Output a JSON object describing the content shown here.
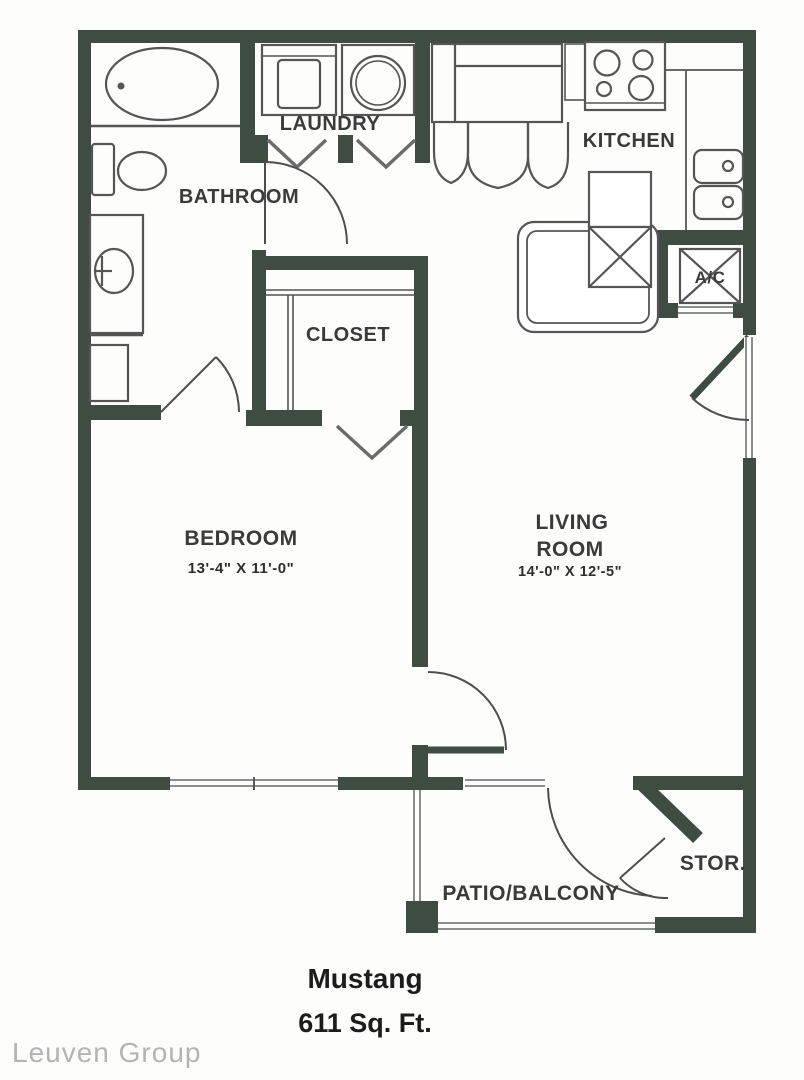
{
  "plan": {
    "title": "Mustang",
    "area": "611 Sq. Ft.",
    "watermark": "Leuven Group",
    "rooms": {
      "laundry": {
        "label": "LAUNDRY"
      },
      "bathroom": {
        "label": "BATHROOM"
      },
      "kitchen": {
        "label": "KITCHEN"
      },
      "ac_closet": {
        "label": "A/C"
      },
      "closet": {
        "label": "CLOSET"
      },
      "bedroom": {
        "label": "BEDROOM",
        "dimensions": "13'-4\" X 11'-0\""
      },
      "living_room": {
        "label_line1": "LIVING",
        "label_line2": "ROOM",
        "dimensions": "14'-0\" X 12'-5\""
      },
      "patio": {
        "label": "PATIO/BALCONY"
      },
      "storage": {
        "label": "STOR."
      }
    },
    "colors": {
      "wall": "#3f4c42",
      "fixture_line": "#555555",
      "window_line": "#8b8f8c",
      "label_text": "#3a3a3a",
      "title_text": "#1c1c1c",
      "watermark_text": "#b4b4b4"
    }
  }
}
